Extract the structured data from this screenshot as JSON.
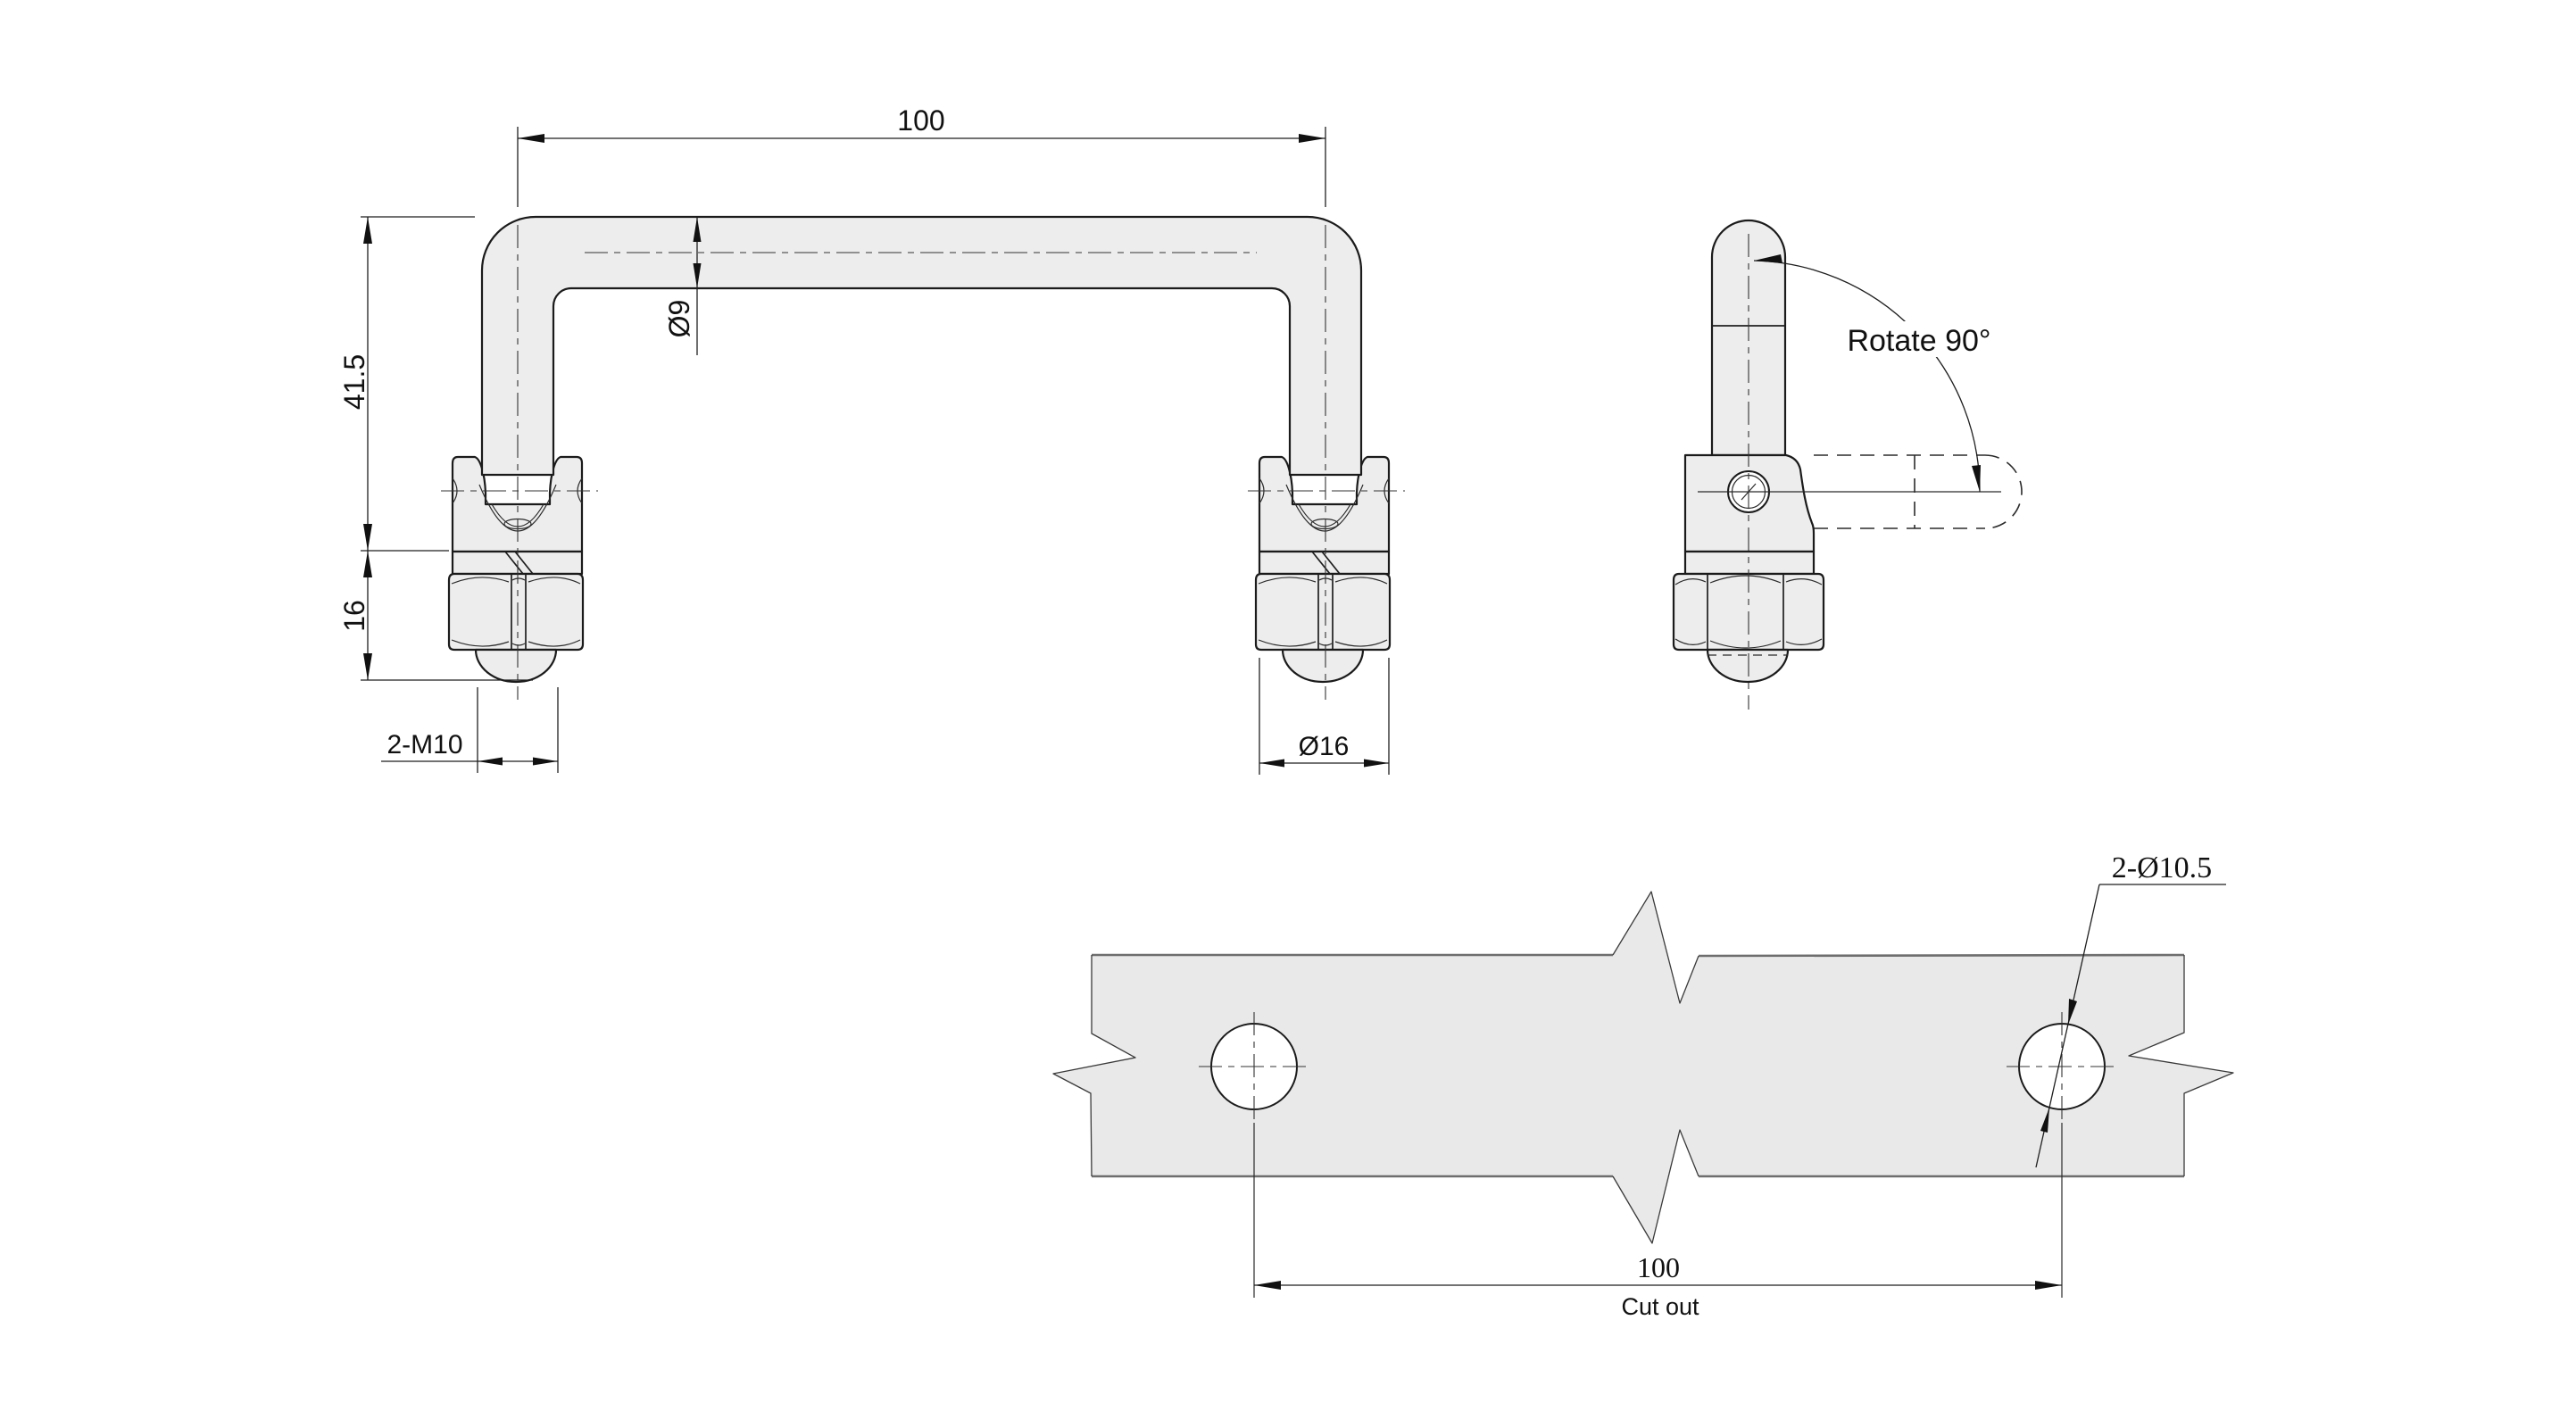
{
  "drawing": {
    "front_view": {
      "dim_width": "100",
      "dim_height": "41.5",
      "dim_base_height": "16",
      "dim_thread": "2-M10",
      "dim_tube_dia": "Ø9",
      "dim_boss_dia": "Ø16"
    },
    "side_view": {
      "rotate_note": "Rotate 90°"
    },
    "cutout_view": {
      "dim_hole_dia": "2-Ø10.5",
      "dim_hole_spacing": "100",
      "label": "Cut out"
    },
    "colors": {
      "background": "#ffffff",
      "part_fill": "#ededed",
      "plate_fill": "#e9e9e9",
      "plate_edge": "#6e6e6e",
      "outline": "#1b1b1b"
    }
  }
}
